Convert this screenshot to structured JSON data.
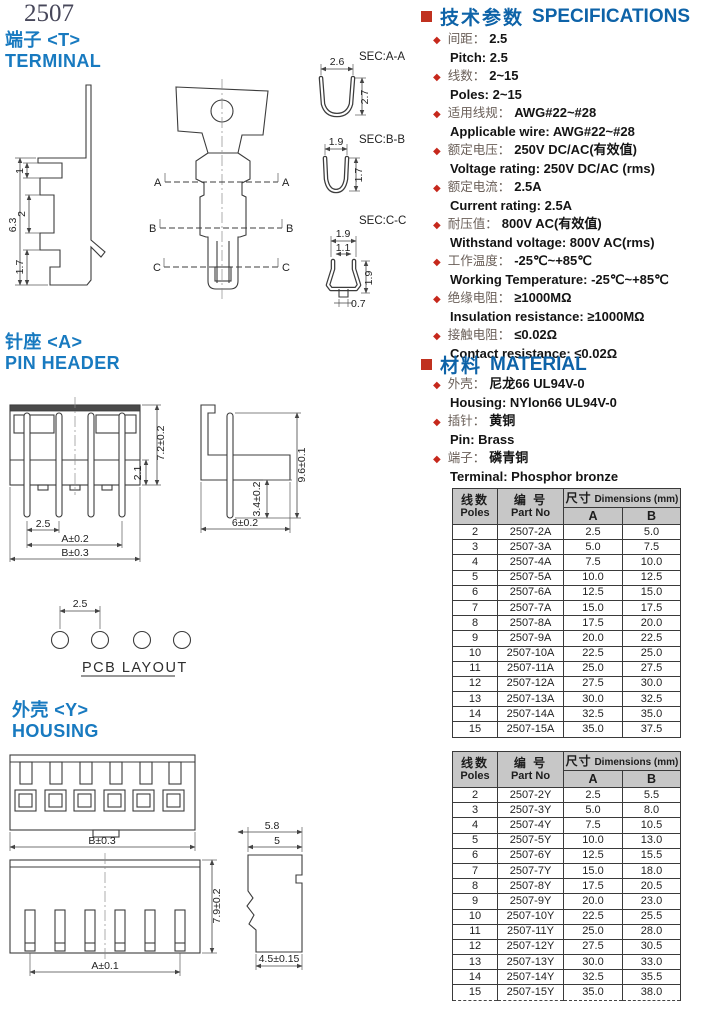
{
  "page": {
    "doc_number": "2507"
  },
  "icons": {
    "diamond": "◆"
  },
  "sections": {
    "terminal": {
      "title_cn": "端子 <T>",
      "title_en": "TERMINAL"
    },
    "pin_header": {
      "title_cn": "针座 <A>",
      "title_en": "PIN HEADER"
    },
    "housing": {
      "title_cn": "外壳 <Y>",
      "title_en": "HOUSING"
    }
  },
  "specifications": {
    "title_cn": "技术参数",
    "title_en": "SPECIFICATIONS",
    "items": [
      {
        "cn": "间距：",
        "cn_val": "2.5",
        "en": "Pitch:  2.5"
      },
      {
        "cn": "线数：",
        "cn_val": "2~15",
        "en": "Poles: 2~15"
      },
      {
        "cn": "适用线规：",
        "cn_val": "AWG#22~#28",
        "en": "Applicable wire: AWG#22~#28"
      },
      {
        "cn": "额定电压：",
        "cn_val": "250V DC/AC(有效值)",
        "en": "Voltage rating: 250V DC/AC (rms)"
      },
      {
        "cn": "额定电流：",
        "cn_val": "2.5A",
        "en": "Current rating: 2.5A"
      },
      {
        "cn": "耐压值：",
        "cn_val": "800V AC(有效值)",
        "en": "Withstand voltage: 800V AC(rms)"
      },
      {
        "cn": "工作温度：",
        "cn_val": "-25℃~+85℃",
        "en": "Working Temperature: -25℃~+85℃"
      },
      {
        "cn": "绝缘电阻：",
        "cn_val": "≥1000MΩ",
        "en": "Insulation resistance: ≥1000MΩ"
      },
      {
        "cn": "接触电阻：",
        "cn_val": "≤0.02Ω",
        "en": "Contact resistance: ≤0.02Ω"
      }
    ]
  },
  "material": {
    "title_cn": "材料",
    "title_en": "MATERIAL",
    "items": [
      {
        "cn": "外壳：",
        "cn_val": "尼龙66    UL94V-0",
        "en": "Housing:  NYlon66   UL94V-0"
      },
      {
        "cn": "插针：",
        "cn_val": "黄铜",
        "en": "Pin:  Brass"
      },
      {
        "cn": "端子：",
        "cn_val": "磷青铜",
        "en": "Terminal:  Phosphor bronze"
      }
    ]
  },
  "tables": [
    {
      "col_poles_cn": "线数",
      "col_poles_en": "Poles",
      "col_part_cn": "编  号",
      "col_part_en": "Part  No",
      "col_dim_cn": "尺寸",
      "col_dim_en": "Dimensions (mm)",
      "col_a": "A",
      "col_b": "B",
      "rows": [
        [
          "2",
          "2507-2A",
          "2.5",
          "5.0"
        ],
        [
          "3",
          "2507-3A",
          "5.0",
          "7.5"
        ],
        [
          "4",
          "2507-4A",
          "7.5",
          "10.0"
        ],
        [
          "5",
          "2507-5A",
          "10.0",
          "12.5"
        ],
        [
          "6",
          "2507-6A",
          "12.5",
          "15.0"
        ],
        [
          "7",
          "2507-7A",
          "15.0",
          "17.5"
        ],
        [
          "8",
          "2507-8A",
          "17.5",
          "20.0"
        ],
        [
          "9",
          "2507-9A",
          "20.0",
          "22.5"
        ],
        [
          "10",
          "2507-10A",
          "22.5",
          "25.0"
        ],
        [
          "11",
          "2507-11A",
          "25.0",
          "27.5"
        ],
        [
          "12",
          "2507-12A",
          "27.5",
          "30.0"
        ],
        [
          "13",
          "2507-13A",
          "30.0",
          "32.5"
        ],
        [
          "14",
          "2507-14A",
          "32.5",
          "35.0"
        ],
        [
          "15",
          "2507-15A",
          "35.0",
          "37.5"
        ]
      ]
    },
    {
      "col_poles_cn": "线数",
      "col_poles_en": "Poles",
      "col_part_cn": "编  号",
      "col_part_en": "Part  No",
      "col_dim_cn": "尺寸",
      "col_dim_en": "Dimensions (mm)",
      "col_a": "A",
      "col_b": "B",
      "rows": [
        [
          "2",
          "2507-2Y",
          "2.5",
          "5.5"
        ],
        [
          "3",
          "2507-3Y",
          "5.0",
          "8.0"
        ],
        [
          "4",
          "2507-4Y",
          "7.5",
          "10.5"
        ],
        [
          "5",
          "2507-5Y",
          "10.0",
          "13.0"
        ],
        [
          "6",
          "2507-6Y",
          "12.5",
          "15.5"
        ],
        [
          "7",
          "2507-7Y",
          "15.0",
          "18.0"
        ],
        [
          "8",
          "2507-8Y",
          "17.5",
          "20.5"
        ],
        [
          "9",
          "2507-9Y",
          "20.0",
          "23.0"
        ],
        [
          "10",
          "2507-10Y",
          "22.5",
          "25.5"
        ],
        [
          "11",
          "2507-11Y",
          "25.0",
          "28.0"
        ],
        [
          "12",
          "2507-12Y",
          "27.5",
          "30.5"
        ],
        [
          "13",
          "2507-13Y",
          "30.0",
          "33.0"
        ],
        [
          "14",
          "2507-14Y",
          "32.5",
          "35.5"
        ],
        [
          "15",
          "2507-15Y",
          "35.0",
          "38.0"
        ]
      ]
    }
  ],
  "drawings": {
    "terminal": {
      "side": {
        "d63": "6.3",
        "d1": "1",
        "d2": "2",
        "d17": "1.7"
      },
      "marker_a": "A",
      "marker_b": "B",
      "marker_c": "C",
      "sec_a_label": "SEC:A-A",
      "sec_a_w": "2.6",
      "sec_a_h": "2.7",
      "sec_b_label": "SEC:B-B",
      "sec_b_w": "1.9",
      "sec_b_h": "1.7",
      "sec_c_label": "SEC:C-C",
      "sec_c_w": "1.9",
      "sec_c_inner": "1.1",
      "sec_c_h": "1.9",
      "sec_c_bottom": "0.7"
    },
    "pin_header": {
      "pitch": "2.5",
      "dim_a": "A±0.2",
      "dim_b": "B±0.3",
      "height": "7.2±0.2",
      "lower": "2.1",
      "side_w": "6±0.2",
      "side_h": "9.6±0.1",
      "side_tail": "3.4±0.2"
    },
    "pcb": {
      "pitch": "2.5",
      "label": "PCB LAYOUT"
    },
    "housing": {
      "front1_b": "B±0.3",
      "front2_a": "A±0.1",
      "front2_h": "7.9±0.2",
      "side_w1": "5.8",
      "side_w2": "5",
      "side_bottom": "4.5±0.15"
    }
  }
}
